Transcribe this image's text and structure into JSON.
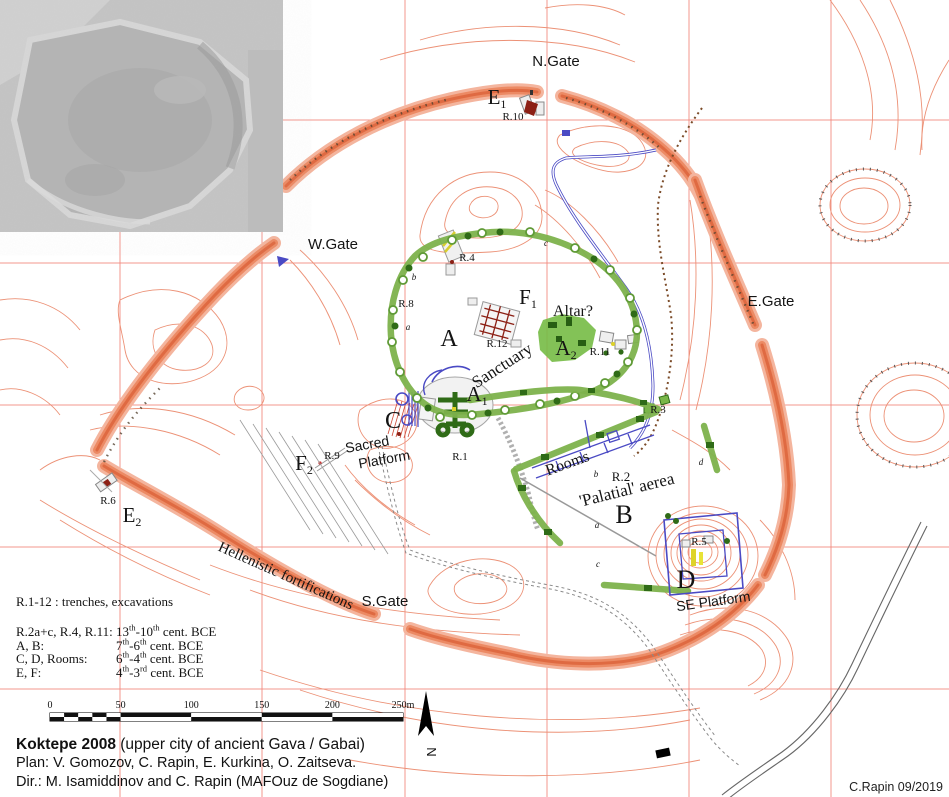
{
  "title_block": {
    "title_bold": "Koktepe 2008",
    "title_rest": " (upper city of ancient Gava / Gabai)",
    "plan_line": "Plan: V. Gomozov, C. Rapin, E. Kurkina, O. Zaitseva.",
    "dir_line": "Dir.: M. Isamiddinov and C. Rapin (MAFOuz de Sogdiane)",
    "credit": "C.Rapin 09/2019"
  },
  "legend": {
    "intro": "R.1-12 : trenches, excavations",
    "rows": [
      {
        "label": "R.2a+c, R.4, R.11:",
        "era": [
          [
            "13"
          ],
          [
            "th",
            1
          ],
          [
            "-10"
          ],
          [
            "th",
            1
          ],
          [
            " cent. BCE"
          ]
        ]
      },
      {
        "label": "A, B:",
        "era": [
          [
            "7"
          ],
          [
            "th",
            1
          ],
          [
            "-6"
          ],
          [
            "th",
            1
          ],
          [
            " cent. BCE"
          ]
        ]
      },
      {
        "label": "C, D, Rooms:",
        "era": [
          [
            "6"
          ],
          [
            "th",
            1
          ],
          [
            "-4"
          ],
          [
            "th",
            1
          ],
          [
            " cent. BCE"
          ]
        ]
      },
      {
        "label": "E, F:",
        "era": [
          [
            "4"
          ],
          [
            "th",
            1
          ],
          [
            "-3"
          ],
          [
            "rd",
            1
          ],
          [
            " cent. BCE"
          ]
        ]
      }
    ]
  },
  "scale_bar": {
    "ticks": [
      "0",
      "50",
      "100",
      "150",
      "200",
      "250m"
    ],
    "x0": 50,
    "x1": 403,
    "y": 713,
    "h": 8
  },
  "colors": {
    "contour": "#ec9176",
    "rampart": "#df6a42",
    "grid": "#f2857b",
    "green": "#7db24c",
    "dark_green": "#2f6b17",
    "blue": "#4a4ac4",
    "dark_red": "#8c2015",
    "yellow": "#ddd22a"
  },
  "map_labels": [
    {
      "n": "n-gate",
      "t": "N.Gate",
      "x": 556,
      "y": 66,
      "fs": 15,
      "f": "sans"
    },
    {
      "n": "w-gate",
      "t": "W.Gate",
      "x": 333,
      "y": 249,
      "fs": 15,
      "f": "sans"
    },
    {
      "n": "e-gate",
      "t": "E.Gate",
      "x": 771,
      "y": 306,
      "fs": 15,
      "f": "sans"
    },
    {
      "n": "s-gate",
      "t": "S.Gate",
      "x": 385,
      "y": 606,
      "fs": 15,
      "f": "sans"
    },
    {
      "n": "area-e1",
      "t": "E",
      "sub": "1",
      "x": 497,
      "y": 104,
      "fs": 21,
      "f": "serif"
    },
    {
      "n": "trench-r10",
      "t": "R.10",
      "x": 513,
      "y": 120,
      "fs": 11,
      "f": "serif"
    },
    {
      "n": "trench-r4",
      "t": "R.4",
      "x": 467,
      "y": 261,
      "fs": 11,
      "f": "serif"
    },
    {
      "n": "trench-r8",
      "t": "R.8",
      "x": 406,
      "y": 307,
      "fs": 11,
      "f": "serif"
    },
    {
      "n": "area-f1",
      "t": "F",
      "sub": "1",
      "x": 528,
      "y": 304,
      "fs": 21,
      "f": "serif"
    },
    {
      "n": "area-a",
      "t": "A",
      "x": 449,
      "y": 346,
      "fs": 24,
      "f": "serif"
    },
    {
      "n": "trench-r12",
      "t": "R.12",
      "x": 497,
      "y": 347,
      "fs": 11,
      "f": "serif"
    },
    {
      "n": "altar",
      "t": "Altar?",
      "x": 573,
      "y": 316,
      "fs": 16,
      "f": "serif"
    },
    {
      "n": "area-a2",
      "t": "A",
      "sub": "2",
      "x": 566,
      "y": 355,
      "fs": 21,
      "f": "serif"
    },
    {
      "n": "trench-r11",
      "t": "R.11",
      "x": 600,
      "y": 355,
      "fs": 11,
      "f": "serif"
    },
    {
      "n": "sanctuary",
      "t": "Sanctuary",
      "x": 505,
      "y": 370,
      "fs": 17,
      "f": "serif",
      "r": -33
    },
    {
      "n": "area-a1",
      "t": "A",
      "sub": "1",
      "x": 477,
      "y": 401,
      "fs": 21,
      "f": "serif"
    },
    {
      "n": "area-c",
      "t": "C",
      "x": 393,
      "y": 428,
      "fs": 24,
      "f": "serif"
    },
    {
      "n": "sacred-platform-line1",
      "t": "Sacred",
      "x": 368,
      "y": 449,
      "fs": 14,
      "f": "sans",
      "r": -10
    },
    {
      "n": "sacred-platform-line2",
      "t": "Platform",
      "x": 385,
      "y": 464,
      "fs": 14,
      "f": "sans",
      "r": -10
    },
    {
      "n": "trench-r1",
      "t": "R.1",
      "x": 460,
      "y": 460,
      "fs": 11,
      "f": "serif"
    },
    {
      "n": "area-f2",
      "t": "F",
      "sub": "2",
      "x": 304,
      "y": 470,
      "fs": 21,
      "f": "serif"
    },
    {
      "n": "trench-r9",
      "t": "R.9",
      "x": 332,
      "y": 459,
      "fs": 11,
      "f": "serif"
    },
    {
      "n": "trench-r6",
      "t": "R.6",
      "x": 108,
      "y": 504,
      "fs": 11,
      "f": "serif"
    },
    {
      "n": "area-e2",
      "t": "E",
      "sub": "2",
      "x": 132,
      "y": 522,
      "fs": 21,
      "f": "serif"
    },
    {
      "n": "hellenistic-fortifications",
      "t": "Hellenistic fortifications",
      "x": 284,
      "y": 580,
      "fs": 15,
      "f": "serif",
      "r": 24
    },
    {
      "n": "trench-r3",
      "t": "R.3",
      "x": 658,
      "y": 413,
      "fs": 11,
      "f": "serif"
    },
    {
      "n": "rooms",
      "t": "Rooms",
      "x": 569,
      "y": 468,
      "fs": 16,
      "f": "serif",
      "r": -20
    },
    {
      "n": "trench-r2",
      "t": "R.2",
      "x": 621,
      "y": 481,
      "fs": 13,
      "f": "serif"
    },
    {
      "n": "palatial-aerea",
      "t": "'Palatial' aerea",
      "x": 628,
      "y": 495,
      "fs": 17,
      "f": "serif",
      "r": -14
    },
    {
      "n": "area-b",
      "t": "B",
      "x": 624,
      "y": 523,
      "fs": 26,
      "f": "serif"
    },
    {
      "n": "trench-r5",
      "t": "R.5",
      "x": 699,
      "y": 545,
      "fs": 11,
      "f": "serif"
    },
    {
      "n": "area-d",
      "t": "D",
      "x": 686,
      "y": 588,
      "fs": 26,
      "f": "serif"
    },
    {
      "n": "se-platform",
      "t": "SE Platform",
      "x": 714,
      "y": 606,
      "fs": 14,
      "f": "sans",
      "r": -8
    },
    {
      "n": "minor-c1",
      "t": "c",
      "x": 546,
      "y": 246,
      "fs": 9,
      "f": "serif",
      "i": 1
    },
    {
      "n": "minor-b1",
      "t": "b",
      "x": 414,
      "y": 280,
      "fs": 9,
      "f": "serif",
      "i": 1
    },
    {
      "n": "minor-a1",
      "t": "a",
      "x": 408,
      "y": 330,
      "fs": 9,
      "f": "serif",
      "i": 1
    },
    {
      "n": "minor-b2",
      "t": "b",
      "x": 596,
      "y": 477,
      "fs": 9,
      "f": "serif",
      "i": 1
    },
    {
      "n": "minor-a2",
      "t": "a",
      "x": 597,
      "y": 528,
      "fs": 9,
      "f": "serif",
      "i": 1
    },
    {
      "n": "minor-c2",
      "t": "c",
      "x": 598,
      "y": 567,
      "fs": 9,
      "f": "serif",
      "i": 1
    },
    {
      "n": "minor-d1",
      "t": "d",
      "x": 701,
      "y": 465,
      "fs": 9,
      "f": "serif",
      "i": 1
    },
    {
      "n": "north-label",
      "t": "N",
      "x": 427,
      "y": 752,
      "fs": 13,
      "f": "sans",
      "r": 90
    }
  ]
}
